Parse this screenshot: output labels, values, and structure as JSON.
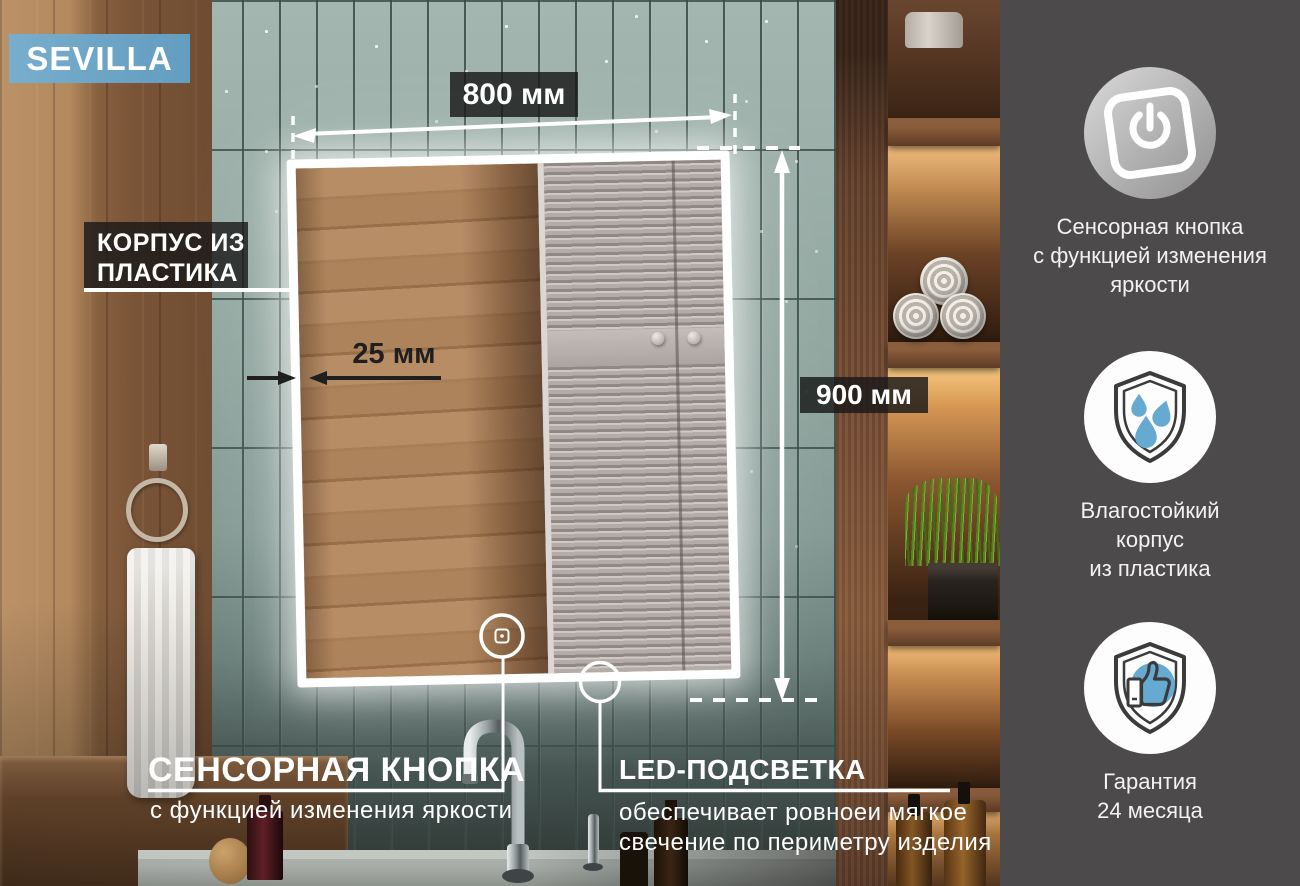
{
  "badge": {
    "label": "SEVILLA"
  },
  "dimensions": {
    "width_label": "800 мм",
    "height_label": "900 мм",
    "frame_label": "25 мм"
  },
  "callouts": {
    "body_material": {
      "line1": "КОРПУС ИЗ",
      "line2": "ПЛАСТИКА"
    },
    "touch_button": {
      "title": "СЕНСОРНАЯ КНОПКА",
      "subtitle": "с функцией изменения яркости"
    },
    "led": {
      "title": "LED-ПОДСВЕТКА",
      "subtitle_line1": "обеспечивает ровноеи мягкое",
      "subtitle_line2": "свечение по периметру изделия"
    }
  },
  "sidebar": {
    "features": [
      {
        "icon": "touch-power-button-icon",
        "lines": [
          "Сенсорная кнопка",
          "с функцией изменения",
          "яркости"
        ]
      },
      {
        "icon": "moisture-shield-icon",
        "lines": [
          "Влагостойкий",
          "корпус",
          "из пластика"
        ]
      },
      {
        "icon": "warranty-thumbs-up-icon",
        "lines": [
          "Гарантия",
          "24 месяца"
        ]
      }
    ]
  },
  "colors": {
    "accent_blue": "#6ba3c6",
    "label_background": "#1c1c1c",
    "label_text": "#ffffff",
    "dimension_dark_text": "#1f1f1f",
    "sidebar_background": "#4d4a4b",
    "icon_blue": "#66a9d1"
  }
}
